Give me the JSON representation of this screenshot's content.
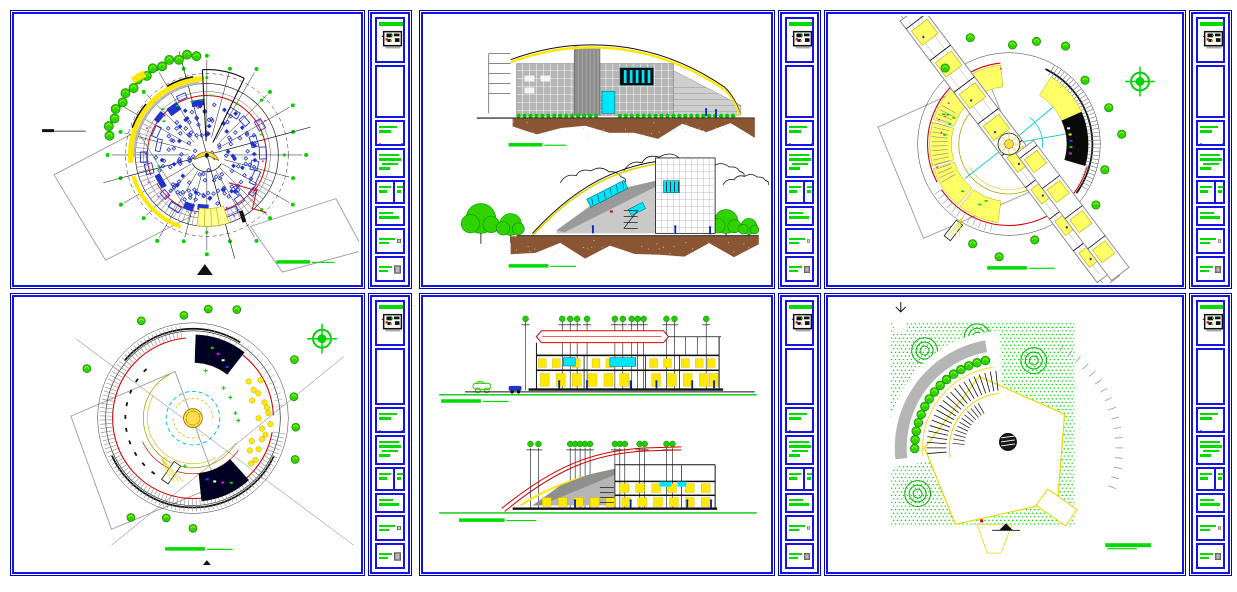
{
  "app": {
    "description": "CAD drawing set - six architectural sheets (circular building plans, elevations, sections, site plan)",
    "background": "#ffffff"
  },
  "palette": {
    "frame_blue": "#1414e6",
    "frame_dark": "#0000b8",
    "green": "#00dc00",
    "tree_green": "#2fd400",
    "yellow": "#ffe800",
    "pale_yellow": "#ffff99",
    "red": "#d00000",
    "cyan": "#00e5ff",
    "magenta": "#ff00ff",
    "gray": "#9a9a9a",
    "wall_gray": "#b5b5b5",
    "ground_brown": "#8a5532",
    "seat_blue": "#2233cc",
    "black": "#111111",
    "navy": "#000022"
  },
  "sheets": [
    {
      "id": "sheet-1",
      "view": "circular-floor-plan-level-1",
      "row": 0,
      "col": 0,
      "type": "plan1"
    },
    {
      "id": "sheet-2",
      "view": "building-elevations",
      "row": 0,
      "col": 1,
      "type": "elevations"
    },
    {
      "id": "sheet-3",
      "view": "circular-floor-plan-level-2",
      "row": 0,
      "col": 2,
      "type": "plan2"
    },
    {
      "id": "sheet-4",
      "view": "circular-roof-plan",
      "row": 1,
      "col": 0,
      "type": "plan3"
    },
    {
      "id": "sheet-5",
      "view": "building-sections",
      "row": 1,
      "col": 1,
      "type": "sections"
    },
    {
      "id": "sheet-6",
      "view": "site-plan",
      "row": 1,
      "col": 2,
      "type": "site"
    }
  ],
  "title_strip": {
    "header": {
      "bar_width": 26,
      "thumbnail": "key-plan-thumbnail"
    },
    "scale_box": {
      "bars": [
        18,
        12
      ]
    },
    "notes_box": {
      "bars": [
        20,
        22,
        16,
        11
      ]
    },
    "split_box": {
      "left_bars": [
        12,
        8
      ],
      "right_bars": [
        7,
        4
      ]
    },
    "notes2_box": {
      "bars": [
        14,
        20
      ]
    },
    "stamp_box": {
      "bars": [
        16,
        10
      ]
    },
    "gray_box": {
      "bars": [
        13,
        9
      ]
    }
  },
  "drawing_params": {
    "plan1": {
      "cx": 192,
      "cy": 140,
      "outer_r": 82,
      "spokes": 24,
      "seat_count": 150,
      "seat_radius": 52,
      "tree_count": 15,
      "ring_rooms": 26
    },
    "plan2": {
      "cx": 180,
      "cy": 129,
      "outer_r": 86,
      "room_sectors": [
        [
          96,
          128
        ],
        [
          130,
          162
        ],
        [
          164,
          196
        ],
        [
          198,
          230
        ],
        [
          232,
          262
        ],
        [
          14,
          58
        ]
      ],
      "bar_angle": 53,
      "trees": 13
    },
    "plan3": {
      "cx": 178,
      "cy": 120,
      "outer_r": 96,
      "red_r": 81,
      "yellow_dots": 18
    },
    "sections": {
      "gridA": [
        101,
        138,
        146,
        153,
        163,
        191,
        199,
        208,
        214,
        220,
        243,
        251,
        283
      ],
      "gridB": [
        106,
        114,
        146,
        151,
        156,
        161,
        166,
        191,
        196,
        201,
        216,
        221,
        243,
        249
      ]
    },
    "site": {
      "square": [
        61,
        23,
        185,
        205
      ],
      "crescent_center": [
        175,
        150
      ],
      "tree_count": 15
    }
  }
}
